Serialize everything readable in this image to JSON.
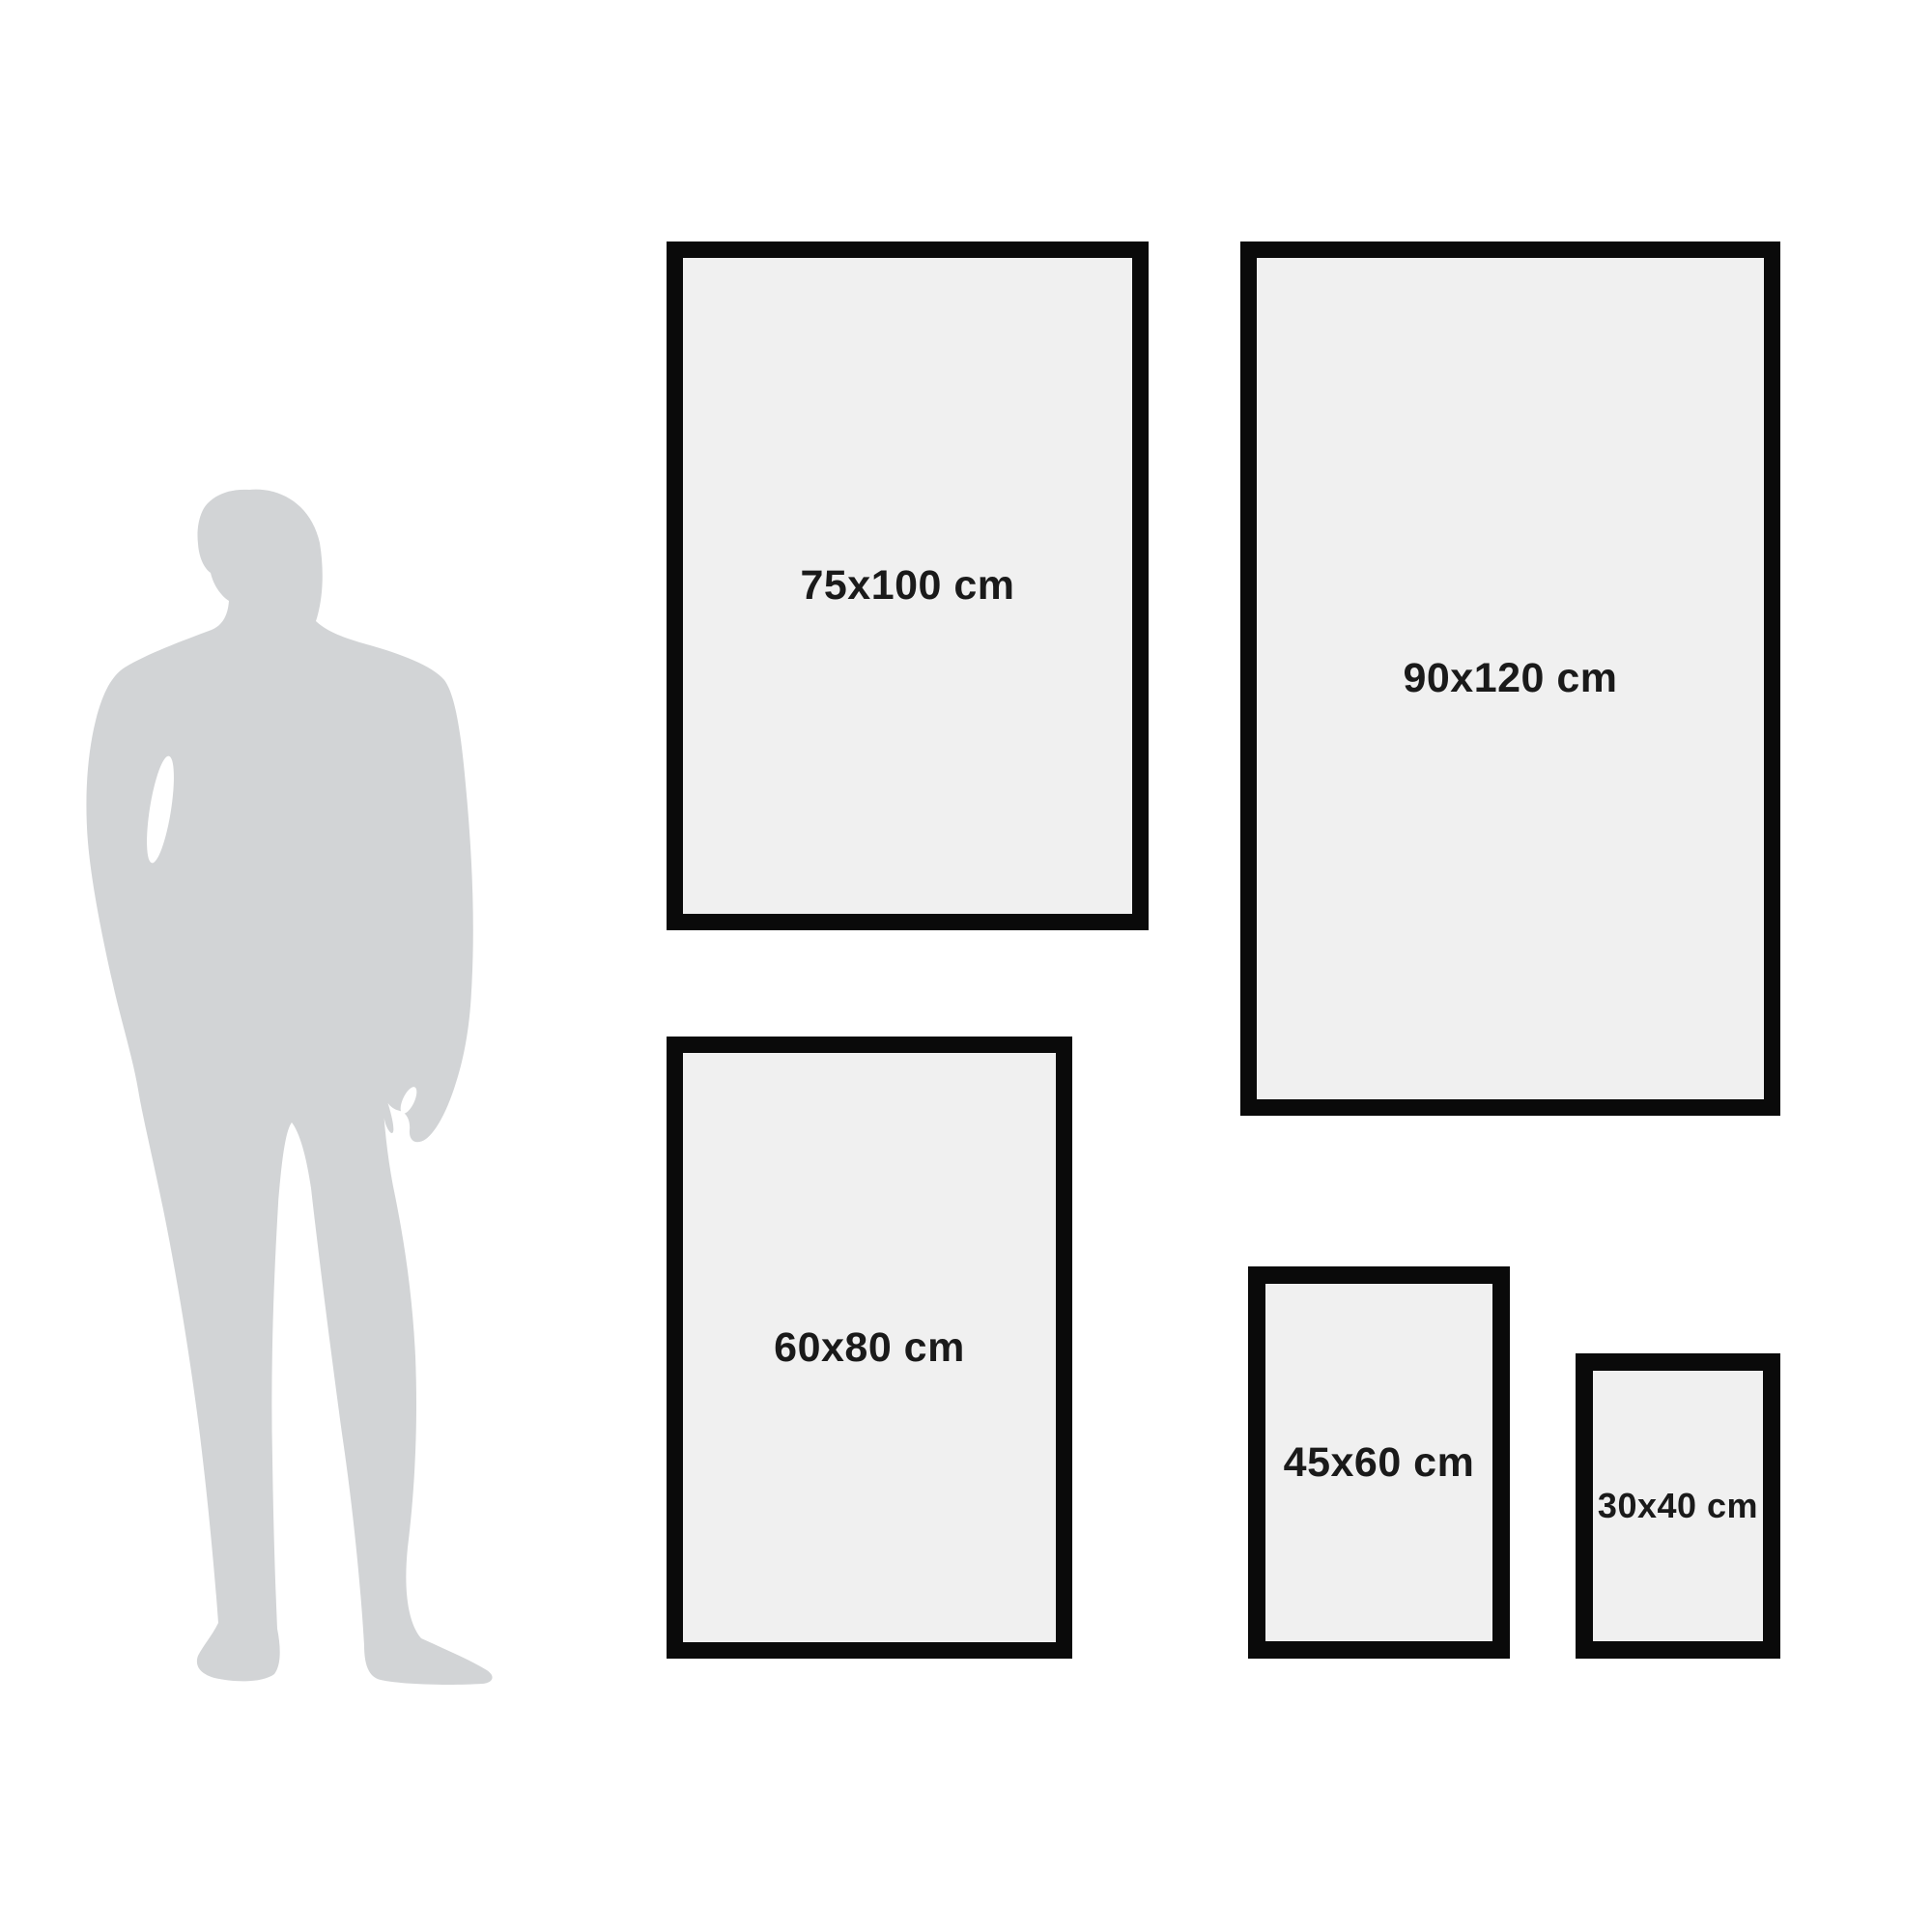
{
  "size_guide": {
    "frames": [
      {
        "label": "75x100 cm",
        "width_cm": 75,
        "height_cm": 100
      },
      {
        "label": "90x120 cm",
        "width_cm": 90,
        "height_cm": 120
      },
      {
        "label": "60x80 cm",
        "width_cm": 60,
        "height_cm": 80
      },
      {
        "label": "45x60 cm",
        "width_cm": 45,
        "height_cm": 60
      },
      {
        "label": "30x40 cm",
        "width_cm": 30,
        "height_cm": 40
      }
    ],
    "reference_figure": "man-silhouette"
  },
  "colors": {
    "background": "#ffffff",
    "frame_border": "#0a0a0a",
    "frame_fill": "#f0f0f0",
    "silhouette": "#d2d4d6",
    "label_text": "#1a1a1a"
  }
}
